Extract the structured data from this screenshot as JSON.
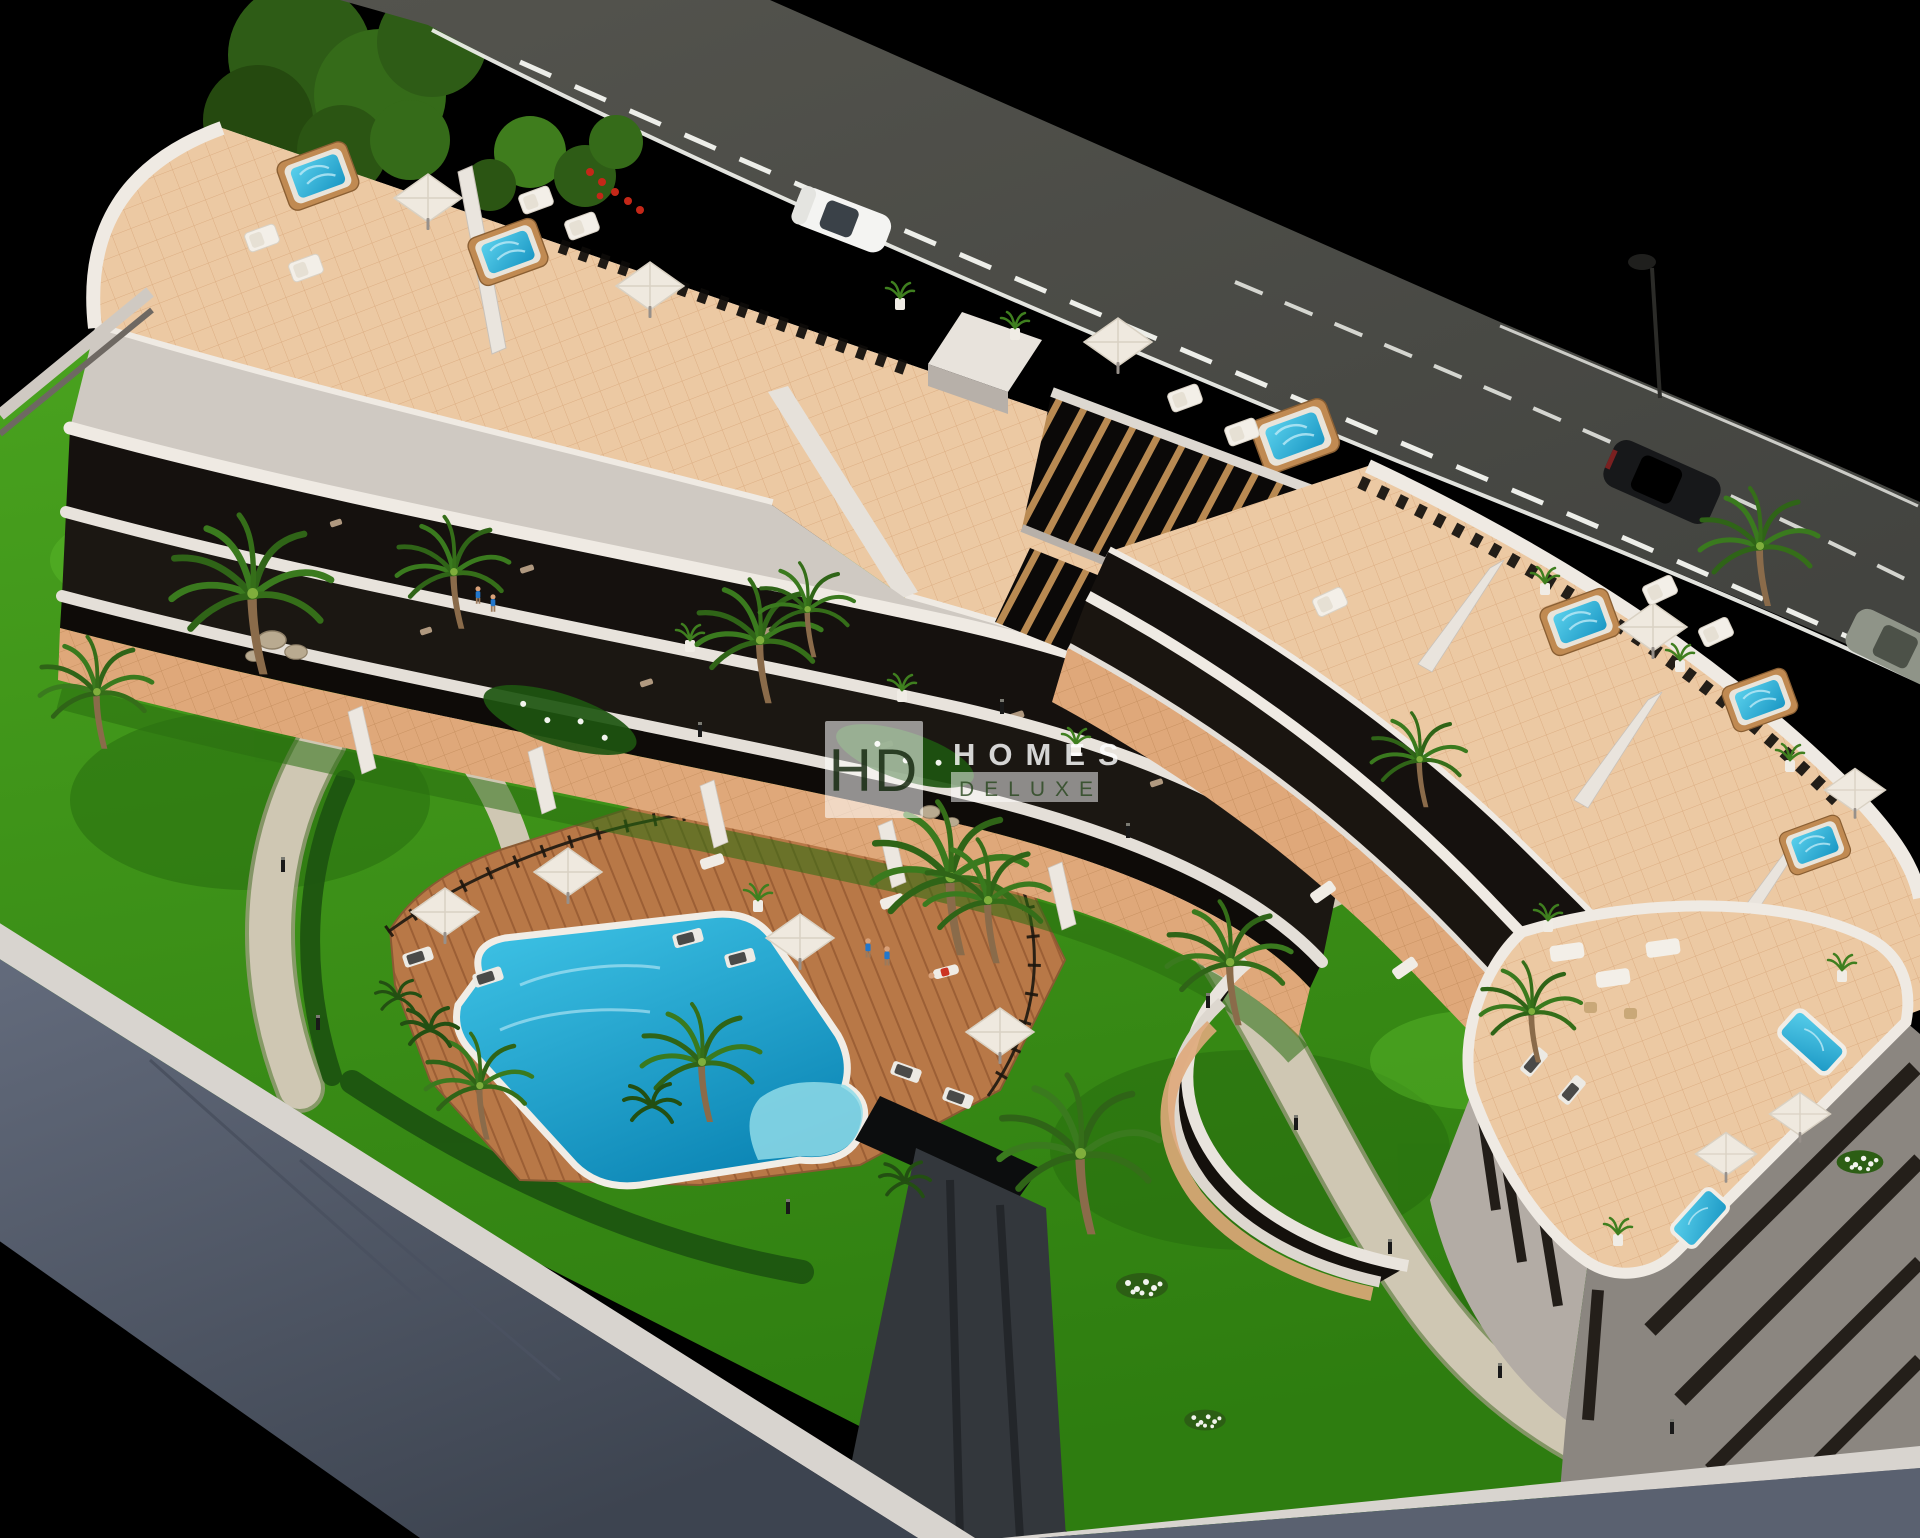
{
  "meta": {
    "kind": "3d-architectural-render",
    "subject": "aerial isometric render of a modern apartment complex with roof-terrace jacuzzis, communal gardens and swimming pool at dusk"
  },
  "watermark": {
    "monogram": "HD",
    "line1": "HOMES",
    "line2": "DELUXE"
  },
  "palette": {
    "background": "#000000",
    "road": "#4c4b46",
    "road-line": "#edeee9",
    "building-white": "#e6e1da",
    "building-shade": "#b5aea7",
    "glass-dark": "#15110e",
    "terrace-tile": "#ecc9a3",
    "ground-terrace": "#dfa87a",
    "deck-wood": "#b87847",
    "deck-line": "#9c5f35",
    "pool-water": "#23b2da",
    "pool-deep": "#0f8fbd",
    "pool-shallow": "#8fdbe8",
    "pool-coping": "#f1ede6",
    "jacuzzi-wood": "#c08a52",
    "lawn": "#3f9c1d",
    "lawn-dark": "#256a0e",
    "hedge": "#1d5510",
    "palm-frond": "#3a7a1e",
    "palm-trunk": "#8a6b4a",
    "path": "#cfc7b3",
    "wall-face": "#57606f",
    "wall-top": "#d8d4cf",
    "ramp": "#33373c",
    "car-white": "#f4f4f2",
    "car-black": "#17181a",
    "car-gray": "#8f9488",
    "umbrella": "#efe9df",
    "flower-red": "#c42718",
    "flower-white": "#f2f4ee"
  }
}
